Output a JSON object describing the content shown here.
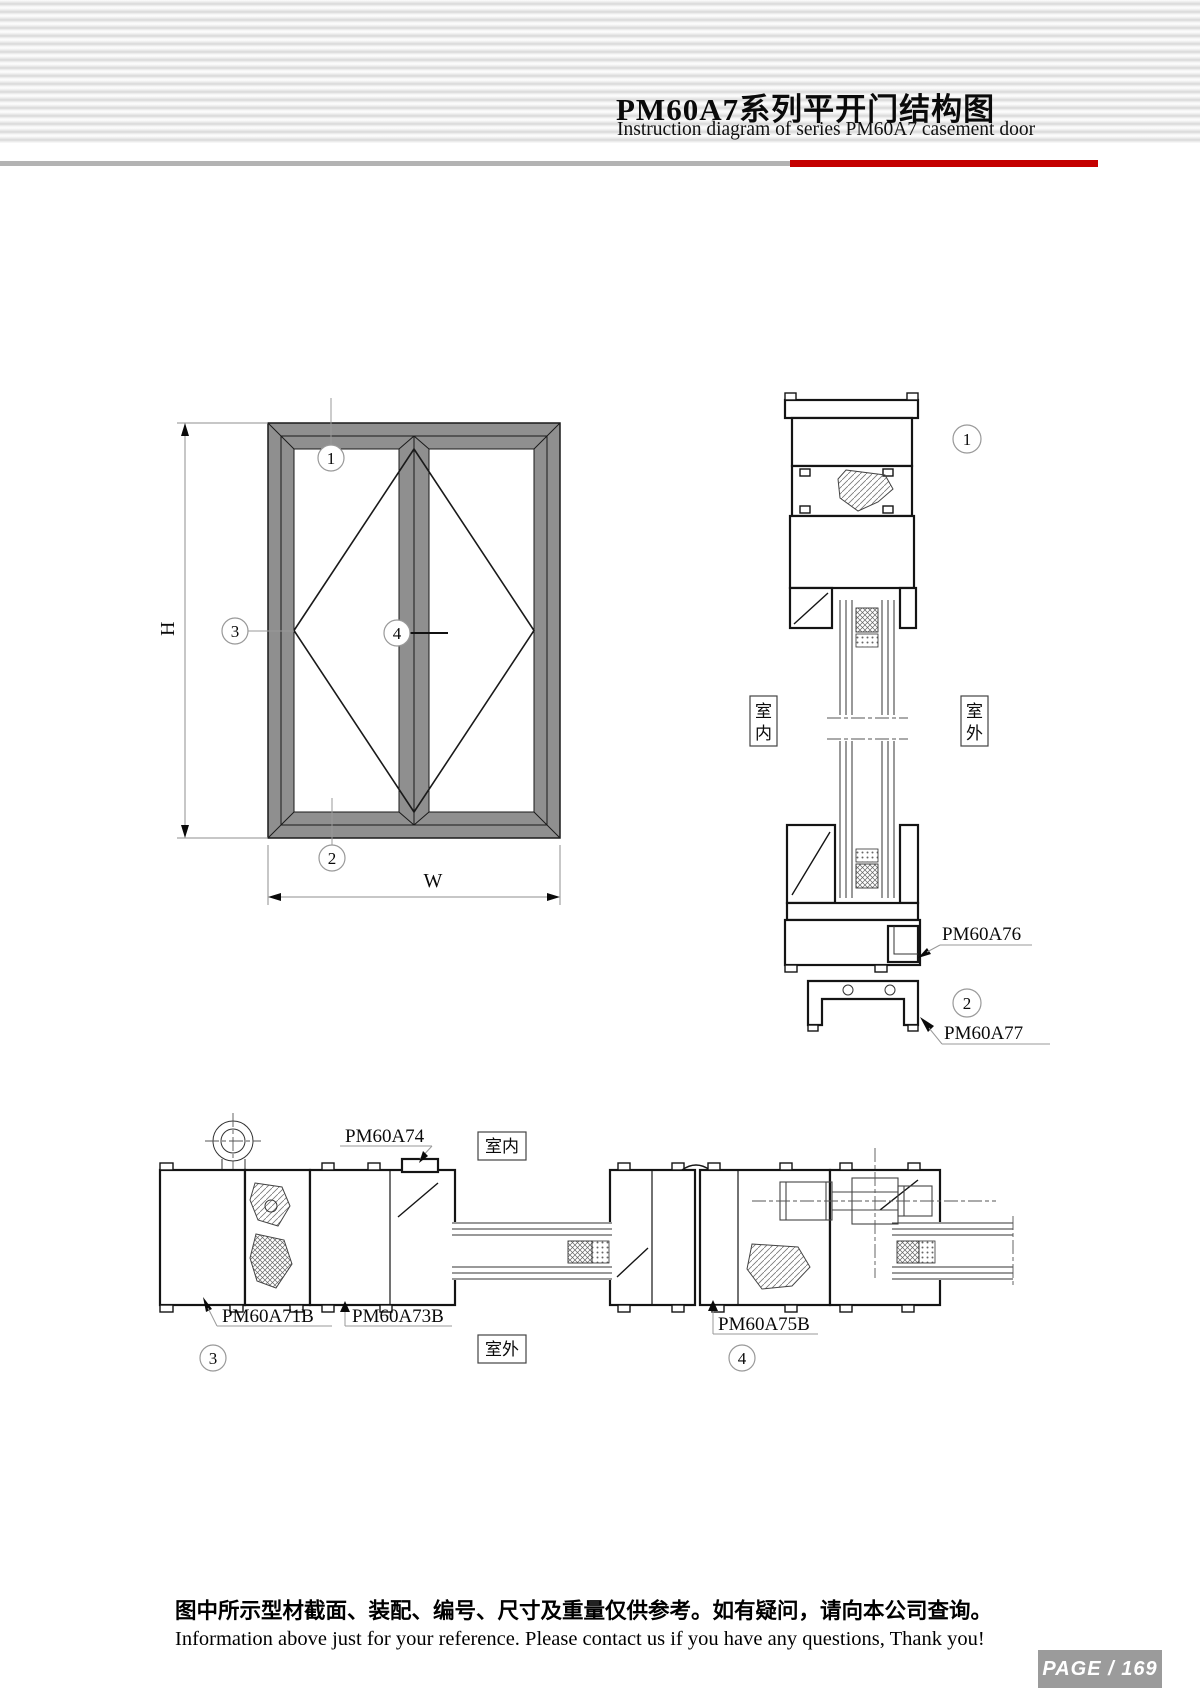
{
  "header": {
    "title_cn": "PM60A7系列平开门结构图",
    "title_en": "Instruction diagram of series PM60A7 casement door"
  },
  "elevation": {
    "h_label": "H",
    "w_label": "W",
    "callout_1": "1",
    "callout_2": "2",
    "callout_3": "3",
    "callout_4": "4"
  },
  "vertical_section": {
    "callout_1": "1",
    "callout_2": "2",
    "indoor_char_top": "室",
    "indoor_char_bottom": "内",
    "outdoor_char_top": "室",
    "outdoor_char_bottom": "外",
    "part_pm60a76": "PM60A76",
    "part_pm60a77": "PM60A77"
  },
  "horizontal_section": {
    "callout_3": "3",
    "callout_4": "4",
    "indoor_label": "室内",
    "outdoor_label": "室外",
    "part_pm60a74": "PM60A74",
    "part_pm60a71b": "PM60A71B",
    "part_pm60a73b": "PM60A73B",
    "part_pm60a75b": "PM60A75B"
  },
  "footer": {
    "note_cn": "图中所示型材截面、装配、编号、尺寸及重量仅供参考。如有疑问，请向本公司查询。",
    "note_en": "Information above just for your reference. Please contact us if you have any questions, Thank you!",
    "page_badge": "PAGE / 169"
  },
  "colors": {
    "accent_red": "#c40000",
    "divider_gray": "#b3b3b3",
    "frame_gray": "#8f8f8f",
    "badge_gray": "#9b9b9b"
  }
}
